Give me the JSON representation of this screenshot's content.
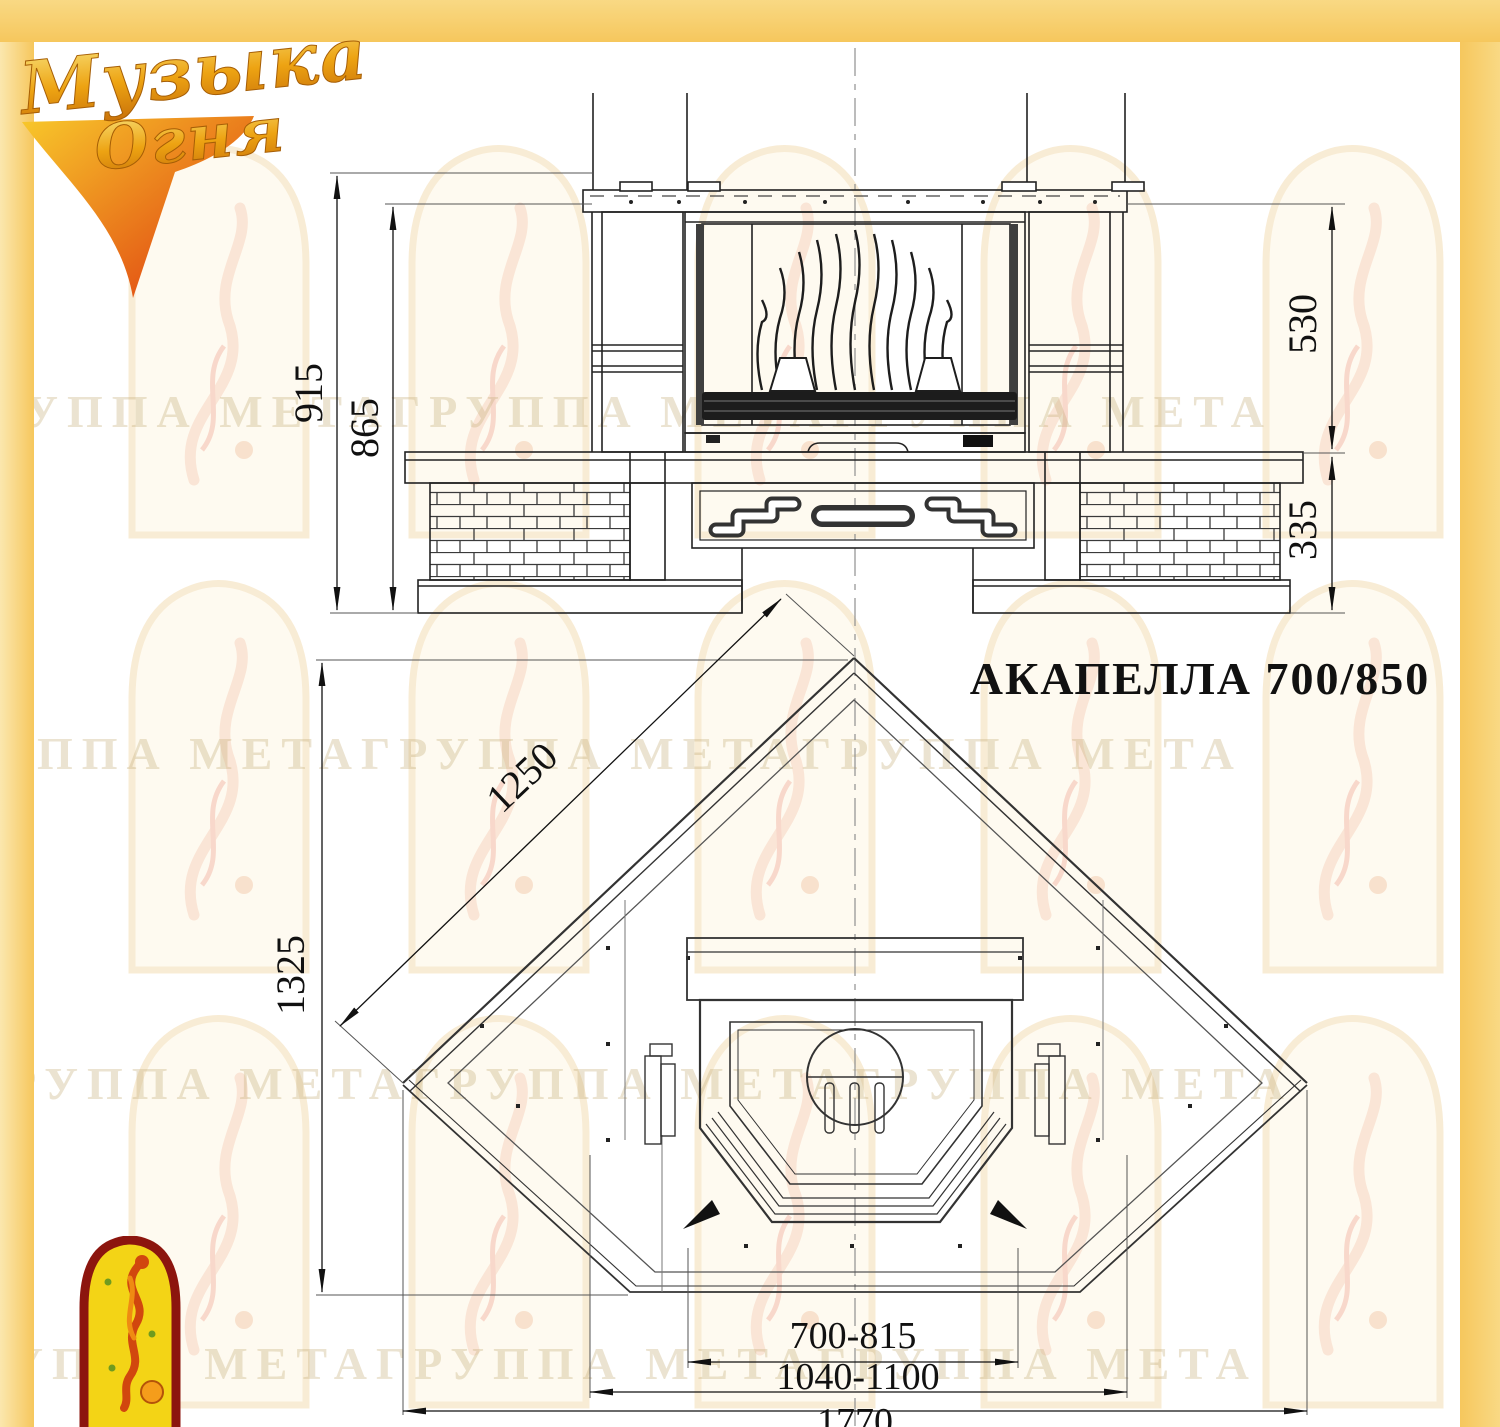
{
  "logo": {
    "line1": "Музыка",
    "line2": "Огня"
  },
  "title": "АКАПЕЛЛА 700/850",
  "watermark_text": "ГРУППА МЕТАГРУППА МЕТАГРУППА МЕТА",
  "front_view": {
    "dim_height_total": "915",
    "dim_height_body": "865",
    "dim_firebox_height": "530",
    "dim_base_height": "335"
  },
  "plan_view": {
    "dim_wall_edge": "1250",
    "dim_depth": "1325",
    "dim_front_opening": "700-815",
    "dim_hearth_front": "1040-1100",
    "dim_total_width": "1770"
  },
  "colors": {
    "accent_yellow": "#f6c75d",
    "line": "#222222",
    "watermark": "#c9b180",
    "emblem_red": "#8c150e",
    "emblem_yellow": "#f3d416"
  }
}
